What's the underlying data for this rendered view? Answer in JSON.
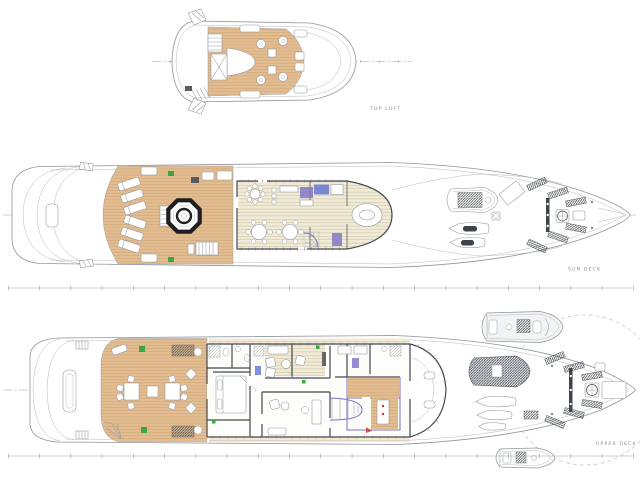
{
  "labels": {
    "top_loft": "TOP LOFT",
    "sun_deck": "SUN DECK",
    "upper_deck": "UPPER DECK"
  },
  "colors": {
    "background": "#ffffff",
    "hull_line": "#8f949b",
    "wall": "#44484f",
    "wood_deck": "#e3bd92",
    "interior_floor": "#f0ead6",
    "jacuzzi_rim": "#1f1f1f",
    "accent_green": "#3aa83e",
    "accent_purple": "#7a6fc8",
    "accent_blue": "#4a5fd0",
    "accent_red": "#cc3333",
    "tender_fill": "#dfe2e5",
    "boat_fill": "#f2f3f4",
    "dash_line": "#9aa0a6",
    "label_text": "#8a8d90"
  }
}
